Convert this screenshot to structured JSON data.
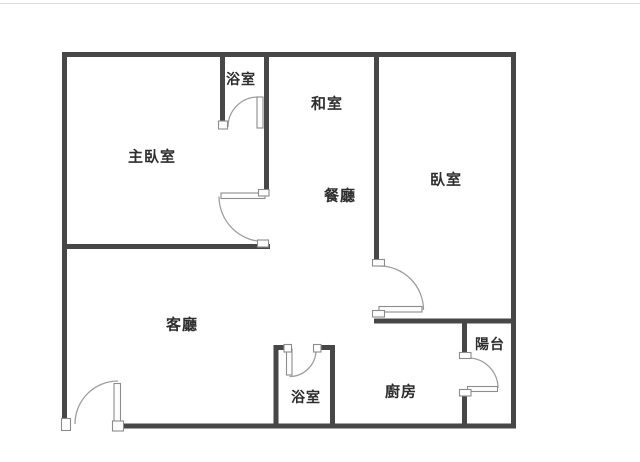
{
  "colors": {
    "wall": "#474747",
    "door_arc": "#9e9e9e",
    "door_panel_border": "#8c8c8c",
    "text": "#2e2e2e",
    "background": "#ffffff"
  },
  "rooms": {
    "master_bedroom": {
      "name": "主臥室"
    },
    "bathroom_top": {
      "name": "浴室"
    },
    "tatami_room": {
      "name": "和室"
    },
    "dining_room": {
      "name": "餐廳"
    },
    "bedroom": {
      "name": "臥室"
    },
    "living_room": {
      "name": "客廳"
    },
    "bathroom_bottom": {
      "name": "浴室"
    },
    "kitchen": {
      "name": "廚房"
    },
    "balcony": {
      "name": "陽台"
    }
  }
}
